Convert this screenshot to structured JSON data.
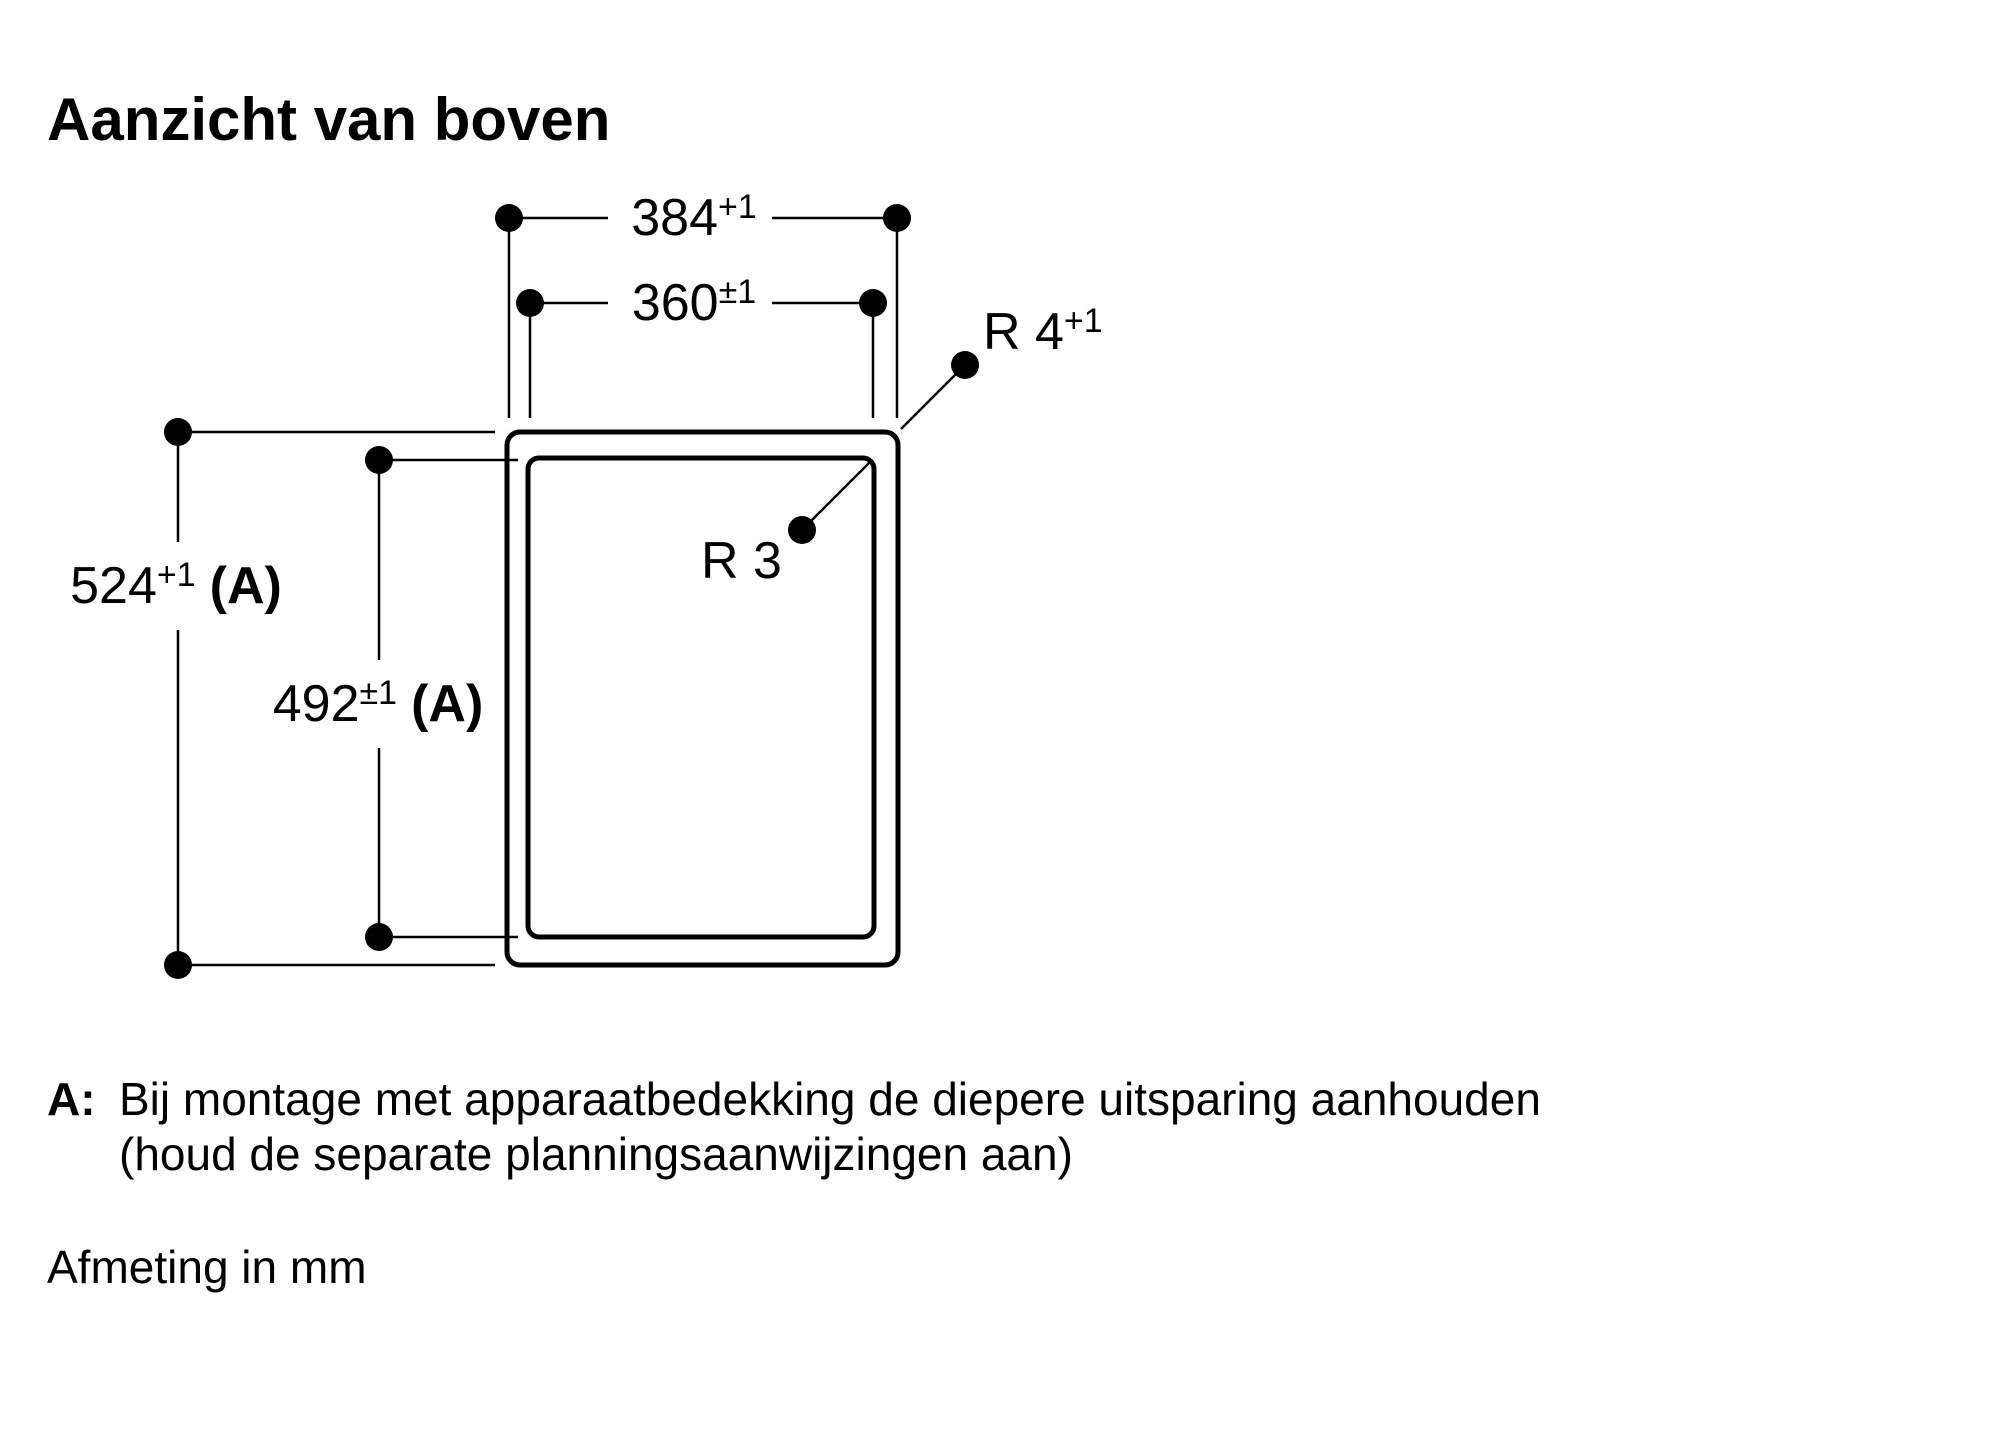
{
  "page": {
    "background_color": "#ffffff",
    "ink_color": "#000000"
  },
  "title": "Aanzicht van boven",
  "dims": {
    "w_outer": {
      "value": "384",
      "tol": "+1"
    },
    "w_inner": {
      "value": "360",
      "tol": "±1"
    },
    "h_outer": {
      "value": "524",
      "tol": "+1",
      "note": "(A)"
    },
    "h_inner": {
      "value": "492",
      "tol": "±1",
      "note": "(A)"
    },
    "r_outer": {
      "value": "R 4",
      "tol": "+1"
    },
    "r_inner": {
      "value": "R 3"
    }
  },
  "footnote": {
    "marker": "A:",
    "line1": "Bij montage met apparaatbedekking de diepere uitsparing aanhouden",
    "line2": "(houd de separate planningsaanwijzingen aan)"
  },
  "units_note": "Afmeting in mm"
}
